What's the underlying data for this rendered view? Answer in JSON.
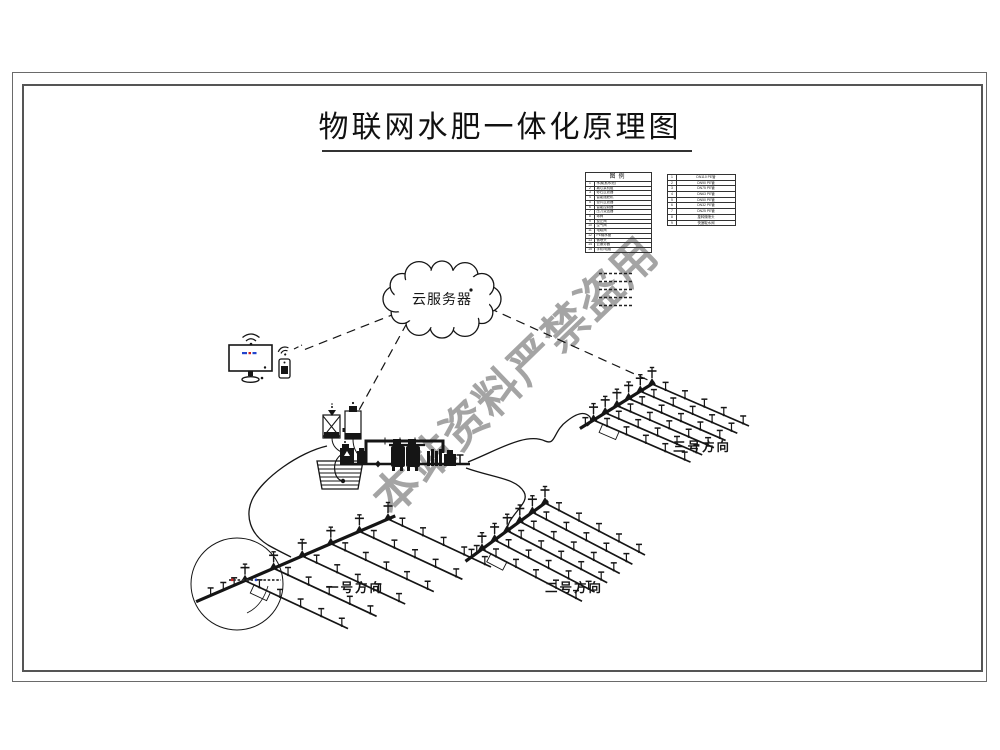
{
  "title": "物联网水肥一体化原理图",
  "watermark": "本站资料严禁盗用",
  "cloud": {
    "label": "云服务器"
  },
  "legend_main": {
    "header": "图例",
    "rows": [
      [
        "1",
        "水源(蓄水池)"
      ],
      [
        "2",
        "离心泵机组"
      ],
      [
        "3",
        "砂石过滤器"
      ],
      [
        "4",
        "智能施肥机"
      ],
      [
        "5",
        "叠片过滤器"
      ],
      [
        "6",
        "智能控制器"
      ],
      [
        "7",
        "压力变送器"
      ],
      [
        "8",
        "球阀"
      ],
      [
        "9",
        "逆止阀"
      ],
      [
        "10",
        "空气阀"
      ],
      [
        "11",
        "电磁阀"
      ],
      [
        "12",
        "PE输水管"
      ],
      [
        "13",
        "微喷头"
      ],
      [
        "14",
        "云服务器"
      ],
      [
        "15",
        "手机/电脑"
      ]
    ]
  },
  "legend_pipes": {
    "rows": [
      [
        "1",
        "DN110 PE管"
      ],
      [
        "2",
        "DN90 PE管"
      ],
      [
        "3",
        "DN75 PE管"
      ],
      [
        "4",
        "DN63 PE管"
      ],
      [
        "5",
        "DN50 PE管"
      ],
      [
        "6",
        "DN32 PE管"
      ],
      [
        "7",
        "DN25 PE管"
      ],
      [
        "8",
        "旋转微喷头"
      ],
      [
        "9",
        "快速取水阀"
      ]
    ]
  },
  "fields": {
    "one": "一号方向",
    "two": "二号方向",
    "three": "三号方向"
  },
  "colors": {
    "ink": "#151515",
    "watermark": "#a4a4a4",
    "screen_blue": "#2244cc",
    "screen_red": "#cc2222"
  }
}
